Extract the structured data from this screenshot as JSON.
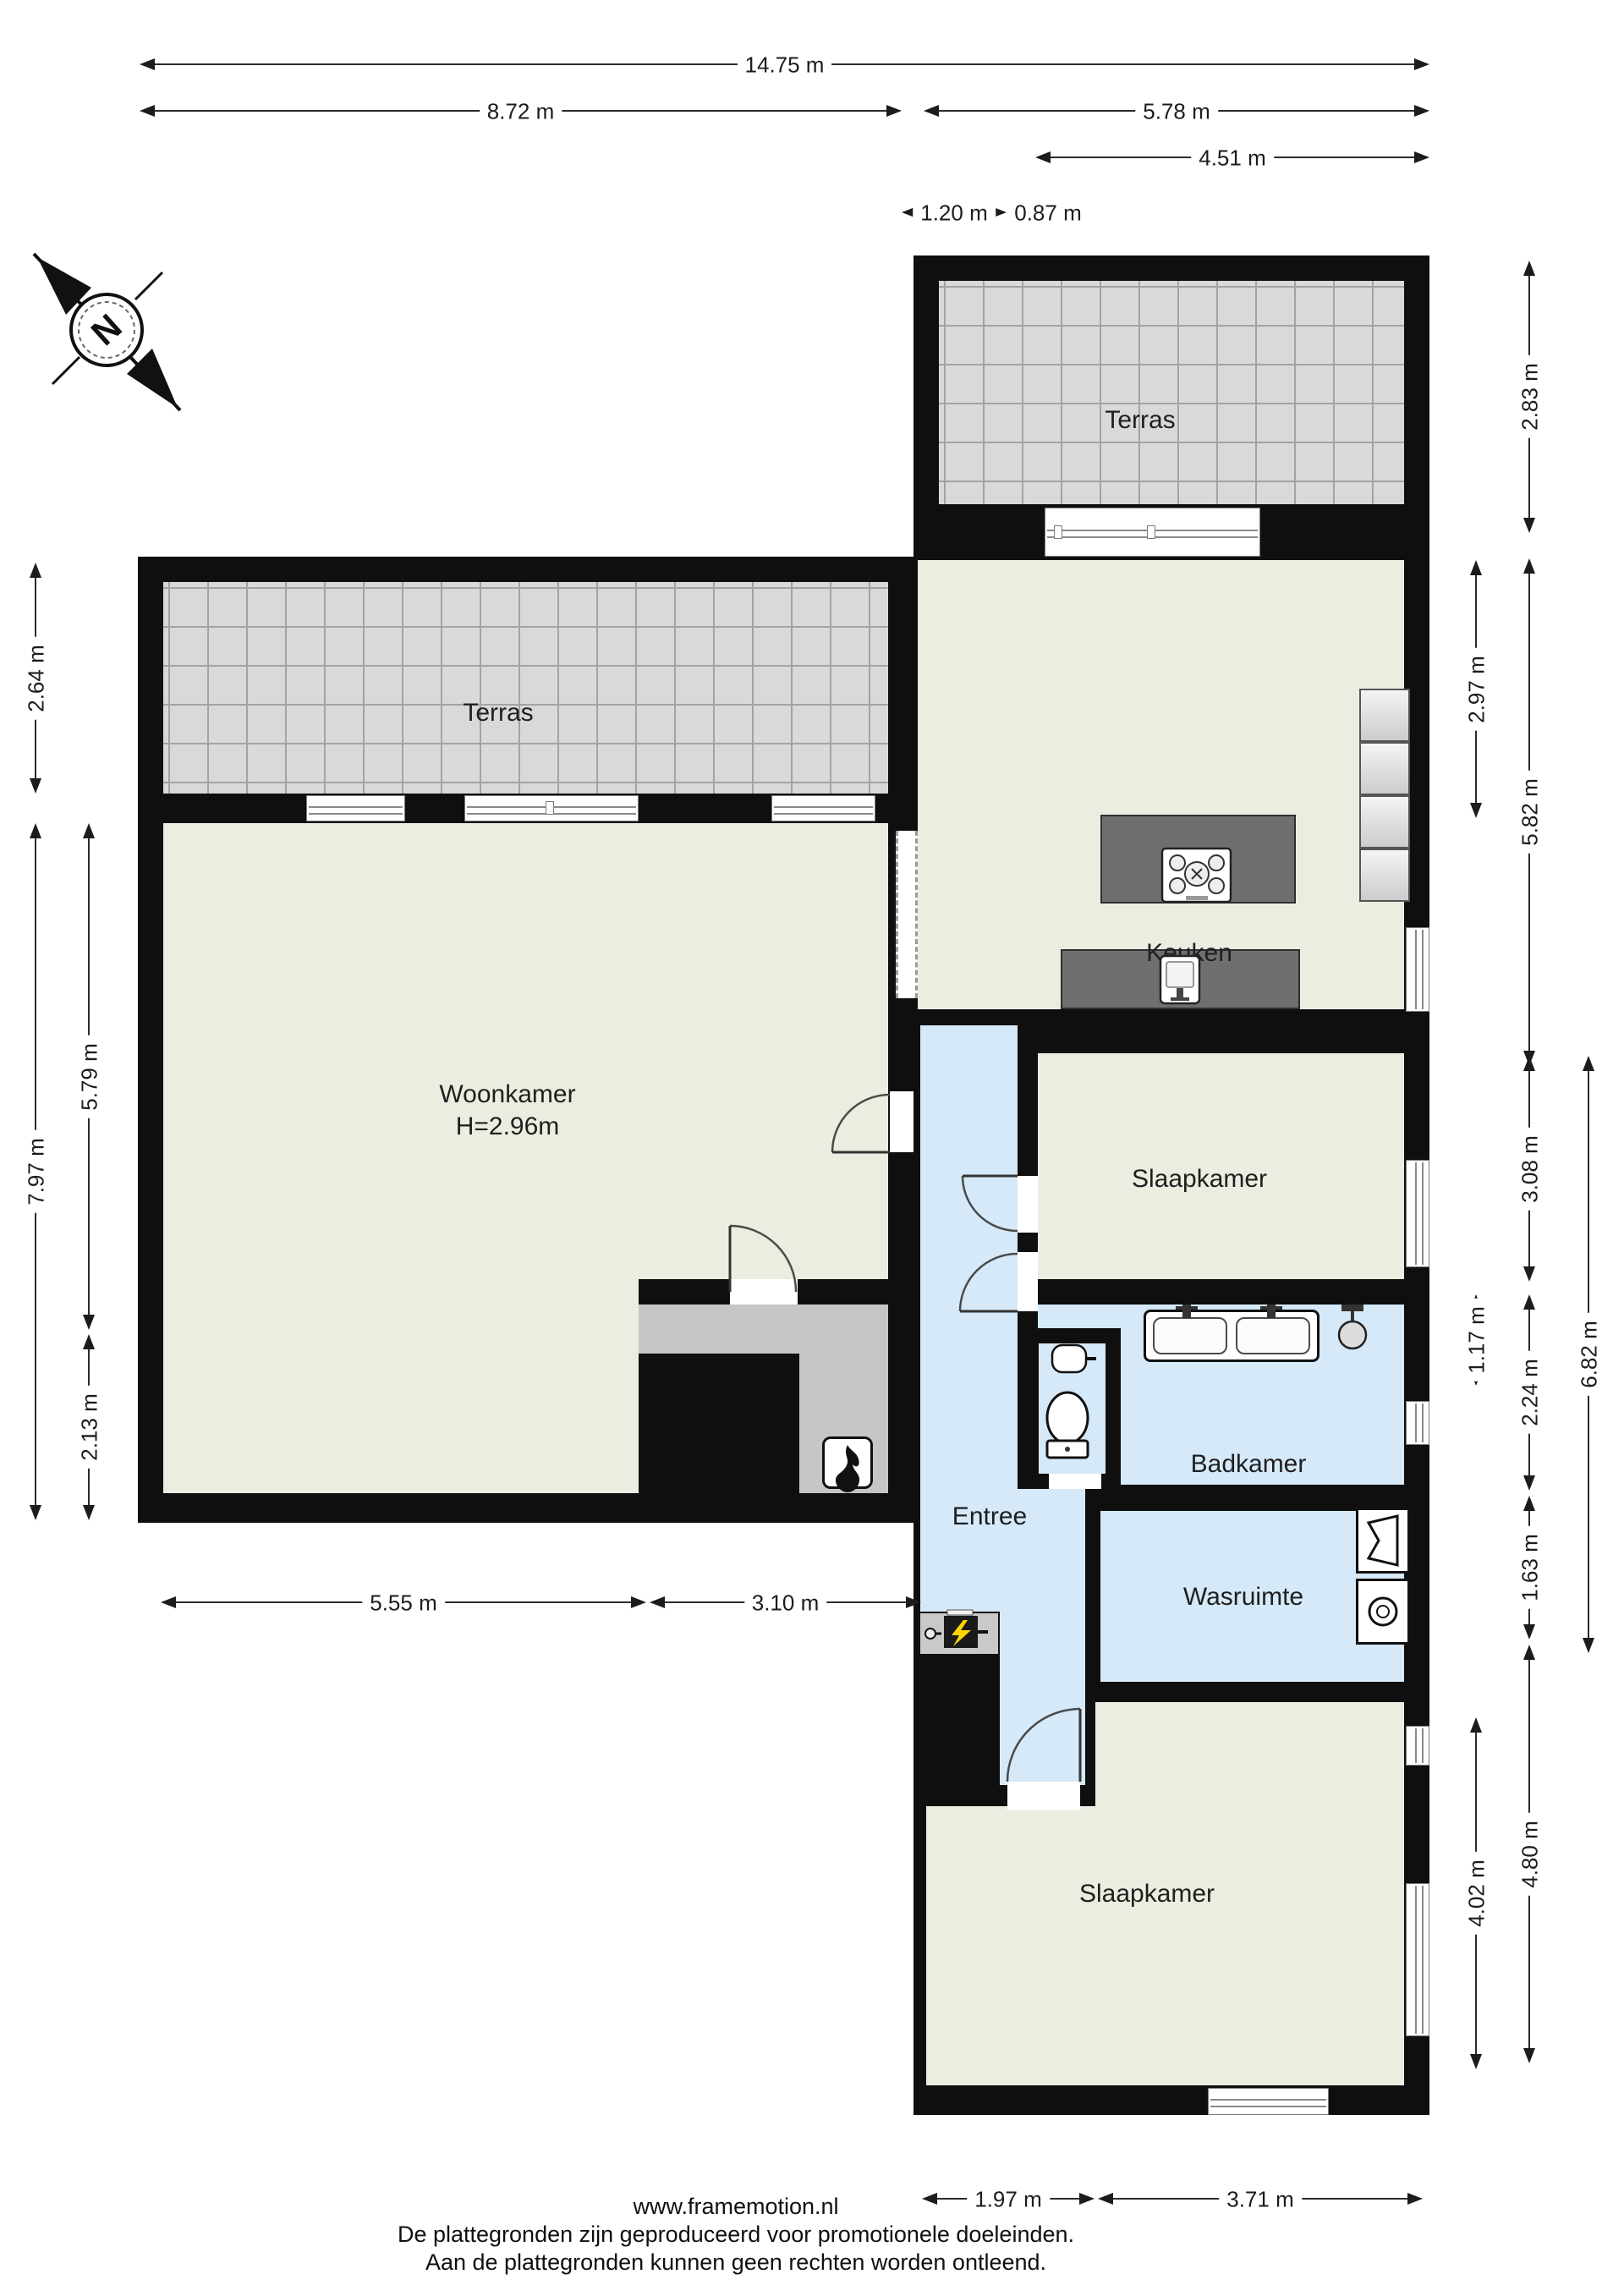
{
  "page": {
    "footer_lines": [
      "www.framemotion.nl",
      "De plattegronden zijn geproduceerd voor promotionele doeleinden.",
      "Aan de plattegronden kunnen geen rechten worden ontleend."
    ]
  },
  "compass": {
    "label": "N"
  },
  "rooms": {
    "terras_top": {
      "label": "Terras"
    },
    "terras_left": {
      "label": "Terras"
    },
    "keuken": {
      "label": "Keuken"
    },
    "woonkamer": {
      "label": "Woonkamer",
      "height_note": "H=2.96m"
    },
    "slaapkamer_top": {
      "label": "Slaapkamer"
    },
    "badkamer": {
      "label": "Badkamer"
    },
    "entree": {
      "label": "Entree"
    },
    "wasruimte": {
      "label": "Wasruimte"
    },
    "slaapkamer_bottom": {
      "label": "Slaapkamer"
    }
  },
  "dimensions": {
    "top_total": "14.75 m",
    "top_left": "8.72 m",
    "top_right": "5.78 m",
    "top_right_inner": "4.51 m",
    "top_small_left": "1.20 m",
    "top_small_right": "0.87 m",
    "left_terrace": "2.64 m",
    "left_living_total": "7.97 m",
    "left_living_upper": "5.79 m",
    "left_living_lower": "2.13 m",
    "right_terrace": "2.83 m",
    "right_kitchen_inner": "2.97 m",
    "right_kitchen_total": "5.82 m",
    "right_bedroom_top": "3.08 m",
    "right_wc": "1.17 m",
    "right_bathroom": "2.24 m",
    "right_laundry": "1.63 m",
    "right_middle_total": "6.82 m",
    "right_bedroom_bottom_outer": "4.80 m",
    "right_bedroom_bottom_inner": "4.02 m",
    "bottom_living_left": "5.55 m",
    "bottom_living_right": "3.10 m",
    "bottom_bedroom_left": "1.97 m",
    "bottom_bedroom_right": "3.71 m"
  },
  "icons": {
    "compass": "compass-rose-icon",
    "cooktop": "cooktop-icon",
    "kitchen_sink": "kitchen-sink-icon",
    "double_washbasin": "double-washbasin-icon",
    "shower": "shower-head-icon",
    "toilet": "toilet-icon",
    "wc_sink": "small-sink-icon",
    "washer": "washing-machine-icon",
    "dryer": "dryer-icon",
    "fireplace": "fireplace-flame-icon",
    "meter": "electric-meter-icon"
  },
  "colors": {
    "wall": "#0f0f0f",
    "floor_beige": "#ecece1",
    "floor_wet_blue": "#d5e9f8",
    "terrace_gray": "#d9d9d9",
    "nook_gray": "#c6c6c6",
    "counter_gray": "#6f6f6f",
    "meter_bolt_yellow": "#ffd400"
  }
}
